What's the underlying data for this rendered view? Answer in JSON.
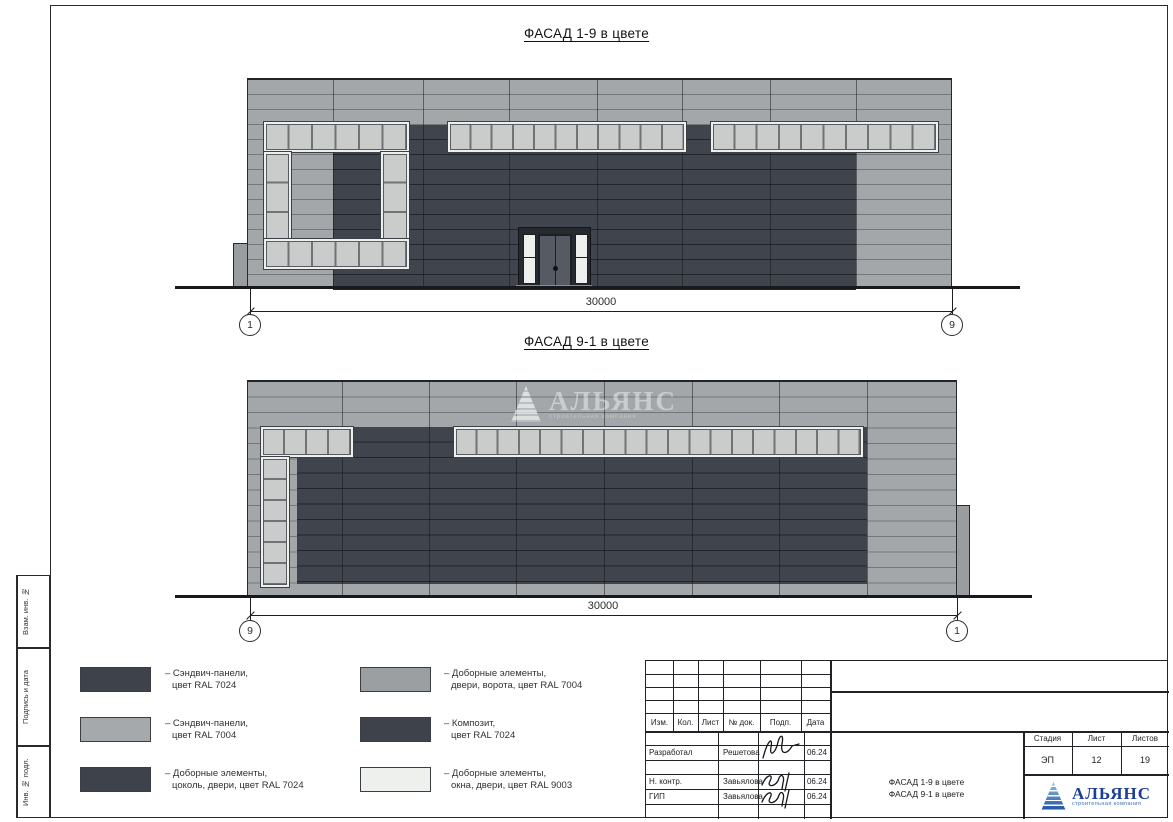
{
  "sheet": {
    "facades": {
      "top": {
        "title": "ФАСАД 1-9 в цвете",
        "dimension": "30000",
        "axis_left": "1",
        "axis_right": "9"
      },
      "bottom": {
        "title": "ФАСАД 9-1 в цвете",
        "dimension": "30000",
        "axis_left": "9",
        "axis_right": "1"
      }
    },
    "watermark": {
      "text": "АЛЬЯНС",
      "subtext": "строительная компания"
    },
    "legend": {
      "items": [
        {
          "line1": "– Сэндвич-панели,",
          "line2": "цвет RAL 7024",
          "color": "#3d424b"
        },
        {
          "line1": "– Сэндвич-панели,",
          "line2": "цвет RAL 7004",
          "color": "#a6a9ab"
        },
        {
          "line1": "– Доборные элементы,",
          "line2": "цоколь, двери, цвет RAL 7024",
          "color": "#3d424b"
        },
        {
          "line1": "– Доборные элементы,",
          "line2": "двери, ворота, цвет RAL 7004",
          "color": "#9b9fa2"
        },
        {
          "line1": "– Композит,",
          "line2": "цвет RAL 7024",
          "color": "#3d424b"
        },
        {
          "line1": "– Доборные элементы,",
          "line2": "окна, двери, цвет RAL 9003",
          "color": "#edf0ed"
        }
      ]
    },
    "margin_stamp": {
      "labels": [
        "Взам. инв. №",
        "Подпись и дата",
        "Инв. № подл."
      ]
    },
    "titleblock": {
      "header_cols": [
        "Изм.",
        "Кол.",
        "Лист",
        "№ док.",
        "Подп.",
        "Дата"
      ],
      "sign_rows": [
        {
          "role": "Разработал",
          "name": "Решетова",
          "date": "06.24"
        },
        {
          "role": "Н. контр.",
          "name": "Завьялова",
          "date": "06.24"
        },
        {
          "role": "ГИП",
          "name": "Завьялова",
          "date": "06.24"
        }
      ],
      "stage_cols": [
        "Стадия",
        "Лист",
        "Листов"
      ],
      "stage_vals": [
        "ЭП",
        "12",
        "19"
      ],
      "sheet_name": [
        "ФАСАД 1-9 в цвете",
        "ФАСАД 9-1 в цвете"
      ],
      "logo": {
        "text": "АЛЬЯНС",
        "subtext": "строительная компания"
      }
    },
    "theme": {
      "panel_dark": "#3f444d",
      "panel_light": "#a4a7a9",
      "window_glass": "#c9ccca",
      "ral9003": "#edf0ed",
      "logo_blue": "#1c3e96",
      "line": "#1f2226"
    }
  }
}
